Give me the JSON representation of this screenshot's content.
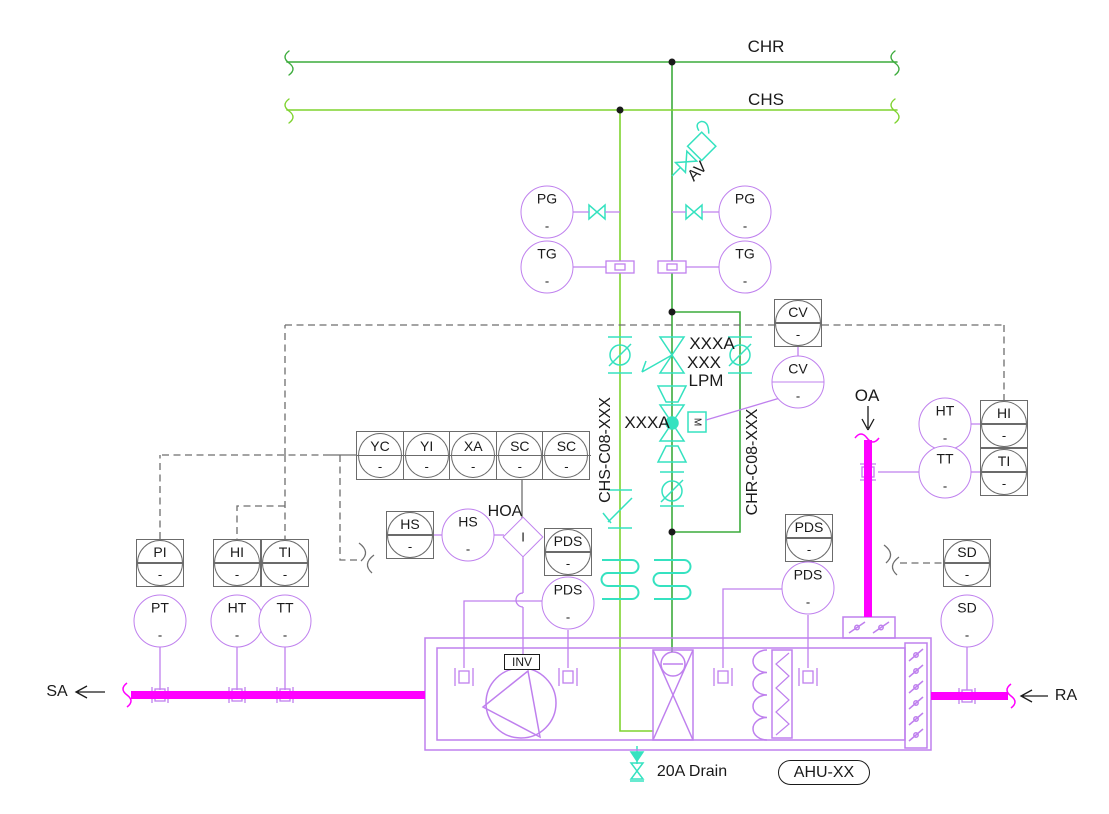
{
  "meta": {
    "drawing_title": "AHU chilled water and airflow control schematic"
  },
  "colors": {
    "chr_pipe": "#3cab3c",
    "chs_pipe": "#7ed32f",
    "valve_cyan": "#35e2c0",
    "equipment_purple": "#bf80ee",
    "duct_magenta": "#ff00ff",
    "signal_gray": "#6e6e6e",
    "text_black": "#1a1a1a"
  },
  "pipes": {
    "chr_label": "CHR",
    "chs_label": "CHS",
    "chs_line_tag": "CHS-C08-XXX",
    "chr_line_tag": "CHR-C08-XXX"
  },
  "ducts": {
    "supply_air": "SA",
    "return_air": "RA",
    "outside_air": "OA"
  },
  "valves": {
    "air_vent": "AV",
    "balance_valve_tag": "XXXA",
    "balance_valve_flow": "XXX",
    "balance_valve_unit": "LPM",
    "control_valve_tag": "XXXA",
    "actuator": "M",
    "drain_label": "20A Drain"
  },
  "unit": {
    "tag": "AHU-XX",
    "inverter": "INV",
    "hoa_label": "HOA",
    "current_switch": "I"
  },
  "instruments": {
    "items": [
      {
        "tag": "PG",
        "sub": "-",
        "shape": "circle",
        "x": 547,
        "y": 212
      },
      {
        "tag": "TG",
        "sub": "-",
        "shape": "circle",
        "x": 547,
        "y": 267
      },
      {
        "tag": "PG",
        "sub": "-",
        "shape": "circle",
        "x": 745,
        "y": 212
      },
      {
        "tag": "TG",
        "sub": "-",
        "shape": "circle",
        "x": 745,
        "y": 267
      },
      {
        "tag": "CV",
        "sub": "-",
        "shape": "box",
        "x": 798,
        "y": 323
      },
      {
        "tag": "CV",
        "sub": "-",
        "shape": "circle",
        "x": 798,
        "y": 382,
        "divider": true
      },
      {
        "tag": "HS",
        "sub": "-",
        "shape": "box",
        "x": 410,
        "y": 535
      },
      {
        "tag": "HS",
        "sub": "-",
        "shape": "circle",
        "x": 468,
        "y": 535
      },
      {
        "tag": "PDS",
        "sub": "-",
        "shape": "box",
        "x": 568,
        "y": 552
      },
      {
        "tag": "PDS",
        "sub": "-",
        "shape": "circle",
        "x": 568,
        "y": 603
      },
      {
        "tag": "PI",
        "sub": "-",
        "shape": "box",
        "x": 160,
        "y": 563
      },
      {
        "tag": "HI",
        "sub": "-",
        "shape": "box",
        "x": 237,
        "y": 563
      },
      {
        "tag": "TI",
        "sub": "-",
        "shape": "box",
        "x": 285,
        "y": 563
      },
      {
        "tag": "PT",
        "sub": "-",
        "shape": "circle",
        "x": 160,
        "y": 621
      },
      {
        "tag": "HT",
        "sub": "-",
        "shape": "circle",
        "x": 237,
        "y": 621
      },
      {
        "tag": "TT",
        "sub": "-",
        "shape": "circle",
        "x": 285,
        "y": 621
      },
      {
        "tag": "PDS",
        "sub": "-",
        "shape": "box",
        "x": 809,
        "y": 538
      },
      {
        "tag": "PDS",
        "sub": "-",
        "shape": "circle",
        "x": 808,
        "y": 588
      },
      {
        "tag": "HT",
        "sub": "-",
        "shape": "circle",
        "x": 945,
        "y": 424
      },
      {
        "tag": "HI",
        "sub": "-",
        "shape": "box",
        "x": 1004,
        "y": 424
      },
      {
        "tag": "TT",
        "sub": "-",
        "shape": "circle",
        "x": 945,
        "y": 472
      },
      {
        "tag": "TI",
        "sub": "-",
        "shape": "box",
        "x": 1004,
        "y": 472
      },
      {
        "tag": "SD",
        "sub": "-",
        "shape": "box",
        "x": 967,
        "y": 563
      },
      {
        "tag": "SD",
        "sub": "-",
        "shape": "circle",
        "x": 967,
        "y": 621
      }
    ],
    "row": {
      "x": 356,
      "y": 431,
      "sub": "-",
      "cells": [
        "YC",
        "YI",
        "XA",
        "SC",
        "SC"
      ]
    }
  }
}
